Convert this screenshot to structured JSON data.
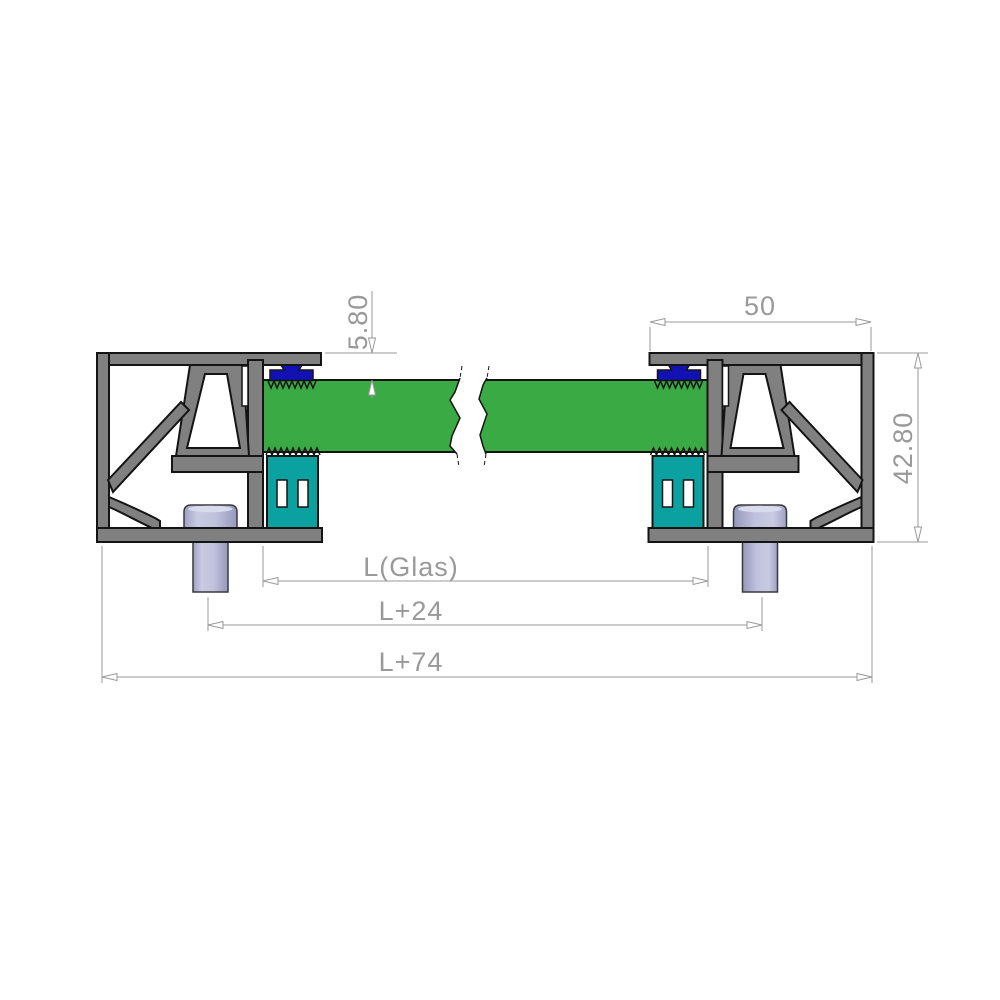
{
  "drawing": {
    "type": "technical-cross-section",
    "dimensions": {
      "glass_inset": "5.80",
      "profile_width": "50",
      "profile_height": "42.80",
      "glass_length": "L(Glas)",
      "length_plus_24": "L+24",
      "length_plus_74": "L+74"
    },
    "colors": {
      "profile_gray": "#808080",
      "glass_green": "#3aaa44",
      "wedge_blue": "#1212b4",
      "setting_block_teal": "#0ba1a1",
      "screw_lavender": "#b4b6d6",
      "screw_highlight": "#d9daec",
      "outline_black": "#141414",
      "dimension_gray": "#999999",
      "dimension_text": "#8f8f8f",
      "background": "#ffffff"
    },
    "components": {
      "left_profile": "aluminium clamping profile (left, section)",
      "right_profile": "aluminium clamping profile (right, mirrored section)",
      "glass": "glass panel shown with break symbol",
      "wedge": "glazing wedge gasket",
      "setting_block": "setting block under glass",
      "screw": "fixing screw"
    }
  }
}
